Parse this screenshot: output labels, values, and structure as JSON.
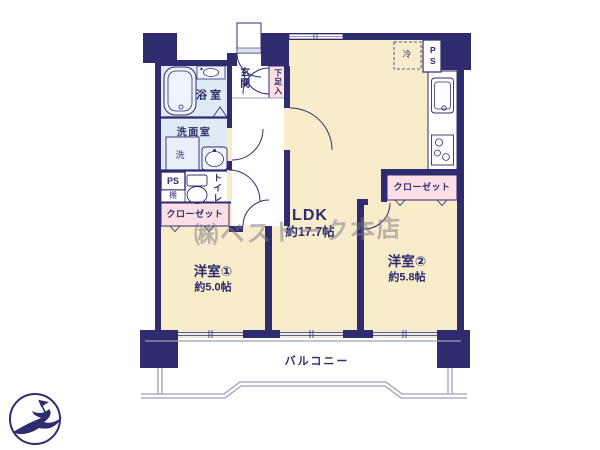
{
  "plan": {
    "watermark": "㈱ベストーク本店",
    "rooms": {
      "ldk": {
        "label": "LDK",
        "area": "約17.7帖"
      },
      "western1": {
        "label": "洋室①",
        "area": "約5.0帖"
      },
      "western2": {
        "label": "洋室②",
        "area": "約5.8帖"
      },
      "bathroom": {
        "label": "浴室"
      },
      "washroom": {
        "label": "洗面室"
      },
      "toilet": {
        "label": "トイレ"
      },
      "entrance": {
        "label": "玄関"
      },
      "balcony": {
        "label": "バルコニー"
      }
    },
    "features": {
      "washer": "洗",
      "shoe_cabinet": "下足入",
      "closet_west1": "クローゼット",
      "closet_west2": "クローゼット",
      "pipe_space_left": "PS",
      "pipe_space_right": "PS",
      "shelf": "棚",
      "refrigerator": "冷"
    },
    "colors": {
      "wall": "#2e2c6e",
      "room_fill": "#f8ecca",
      "wet_area_fill": "#dfeaf5",
      "closet_fill": "#fbdfe5",
      "balcony_line": "#9aa0b5"
    }
  }
}
